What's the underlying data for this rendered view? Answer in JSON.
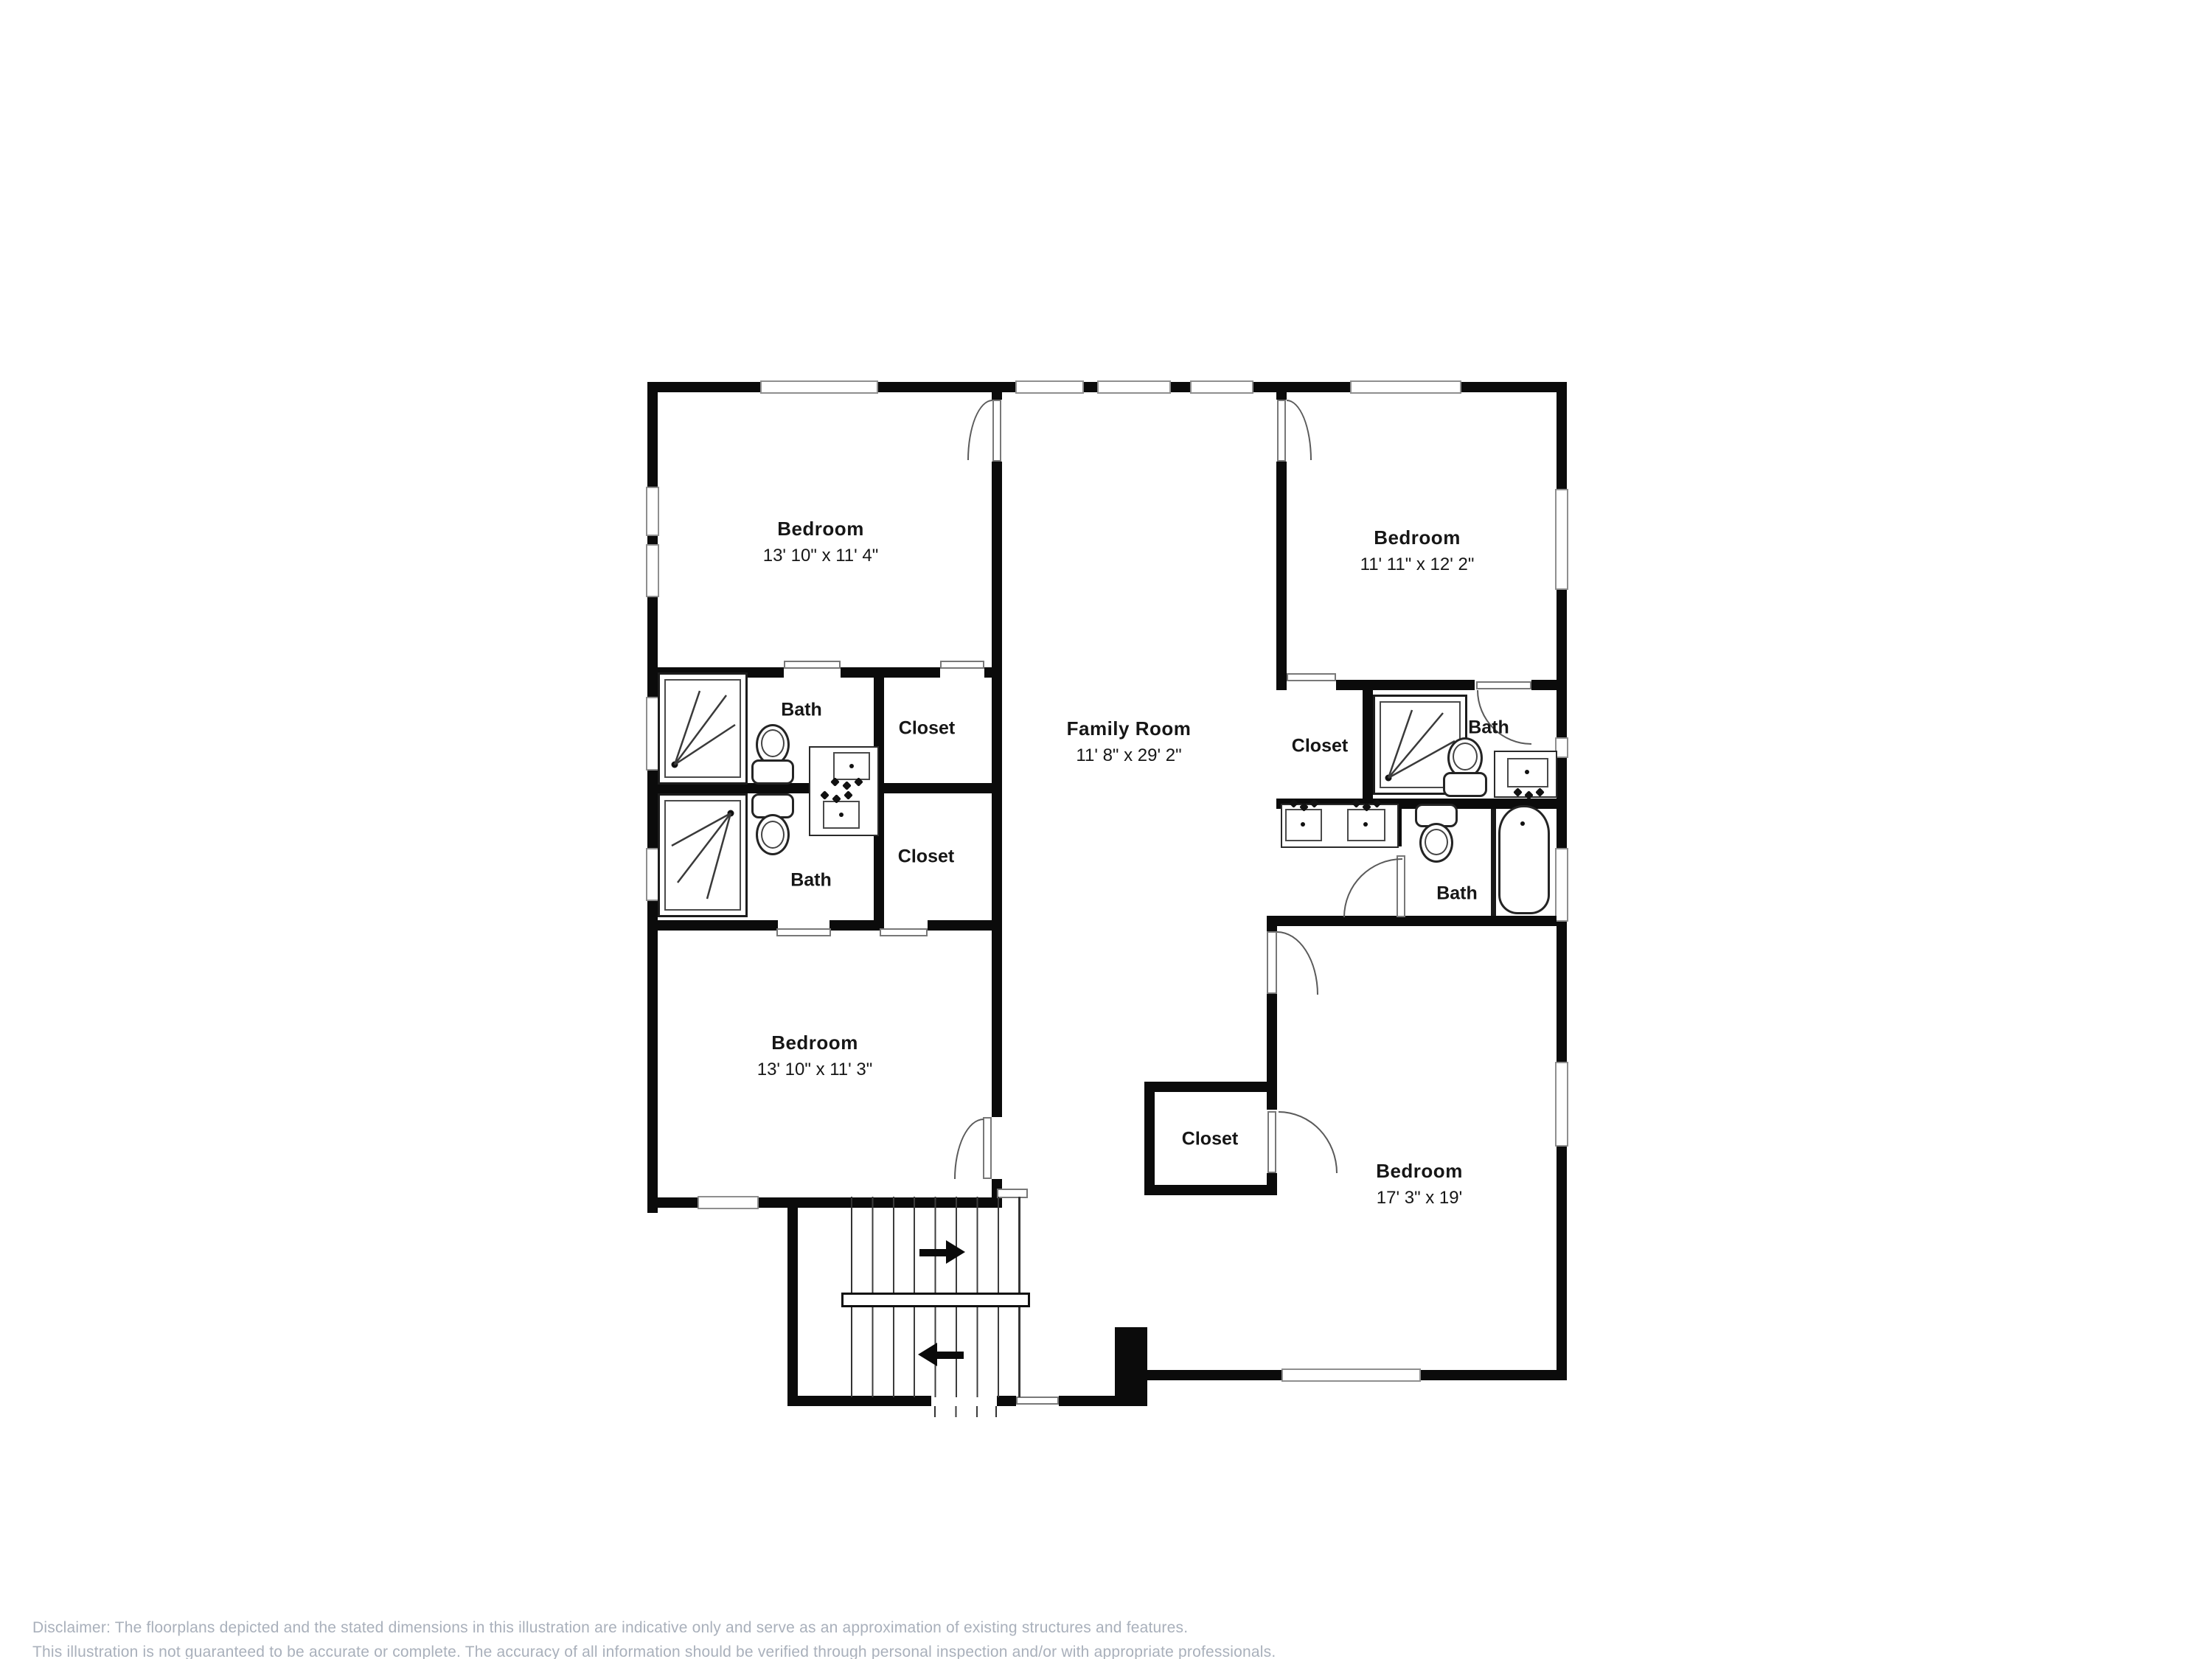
{
  "rooms": {
    "bedroom_top_left": {
      "label": "Bedroom",
      "dims": "13' 10\" x 11' 4\""
    },
    "bedroom_top_right": {
      "label": "Bedroom",
      "dims": "11' 11\" x 12' 2\""
    },
    "family_room": {
      "label": "Family Room",
      "dims": "11' 8\" x 29' 2\""
    },
    "bedroom_bottom_left": {
      "label": "Bedroom",
      "dims": "13' 10\" x 11' 3\""
    },
    "bedroom_bottom_right": {
      "label": "Bedroom",
      "dims": "17' 3\" x 19'"
    },
    "bath_left_upper": {
      "label": "Bath"
    },
    "bath_left_lower": {
      "label": "Bath"
    },
    "bath_right_upper": {
      "label": "Bath"
    },
    "bath_right_lower": {
      "label": "Bath"
    },
    "closet_left_upper": {
      "label": "Closet"
    },
    "closet_left_lower": {
      "label": "Closet"
    },
    "closet_right_upper": {
      "label": "Closet"
    },
    "closet_bottom": {
      "label": "Closet"
    }
  },
  "disclaimer": {
    "line1": "Disclaimer: The floorplans depicted and the stated dimensions in this illustration are indicative only and serve as an approximation of existing structures and features.",
    "line2": "This illustration is not guaranteed to be accurate or complete. The accuracy of all information should be verified through personal inspection and/or with appropriate professionals."
  }
}
